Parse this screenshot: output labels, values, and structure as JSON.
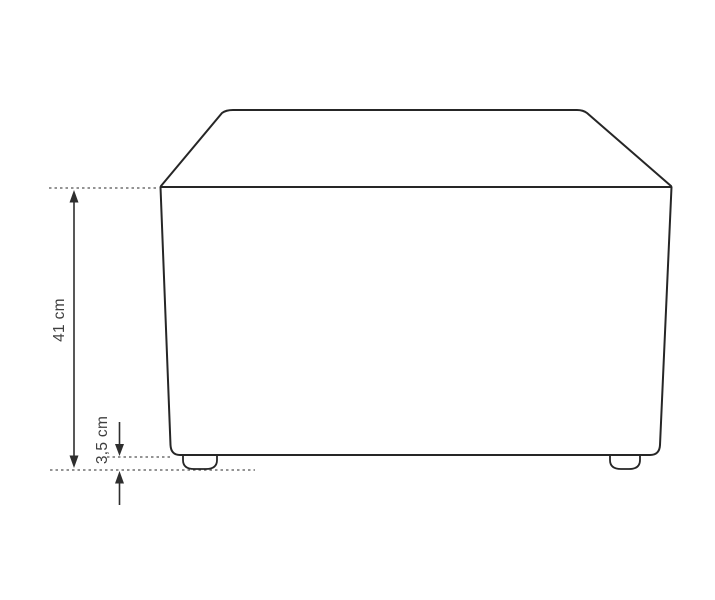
{
  "diagram": {
    "type": "furniture-dimension-diagram",
    "subject": "ottoman-front-view",
    "labels": {
      "total_height": "41 cm",
      "leg_height": "3,5 cm"
    },
    "measurements": {
      "total_height_cm": 41,
      "leg_height_cm": 3.5
    },
    "colors": {
      "background": "#ffffff",
      "outline": "#262626",
      "dimension_line": "#2e2e2e",
      "guide_dotted": "#555555",
      "label_text": "#3f3f3f"
    }
  }
}
